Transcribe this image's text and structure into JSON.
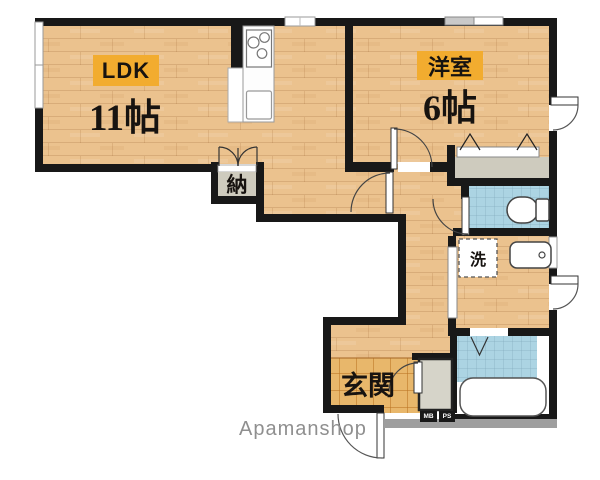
{
  "plan": {
    "type": "apartment-floor-plan",
    "rooms": {
      "ldk": {
        "label": "LDK",
        "size": "11帖"
      },
      "western_room": {
        "label": "洋室",
        "size": "6帖"
      },
      "storage": {
        "label": "納"
      },
      "laundry": {
        "label": "洗"
      },
      "entrance": {
        "label": "玄関"
      }
    },
    "utilities": {
      "meter_box": "MB",
      "pipe_space": "PS"
    },
    "watermark": "Apamanshop",
    "colors": {
      "highlight_badge": "#F2AC2F",
      "wood_floor": "#EBC28E",
      "entrance_tile": "#E8B76B",
      "wet_area_blue": "#ACD4E3",
      "closet_gray": "#CECBBE",
      "wall_black": "#181818",
      "slab_gray": "#9E9E9E",
      "watermark_gray": "#8F8F8F"
    }
  }
}
